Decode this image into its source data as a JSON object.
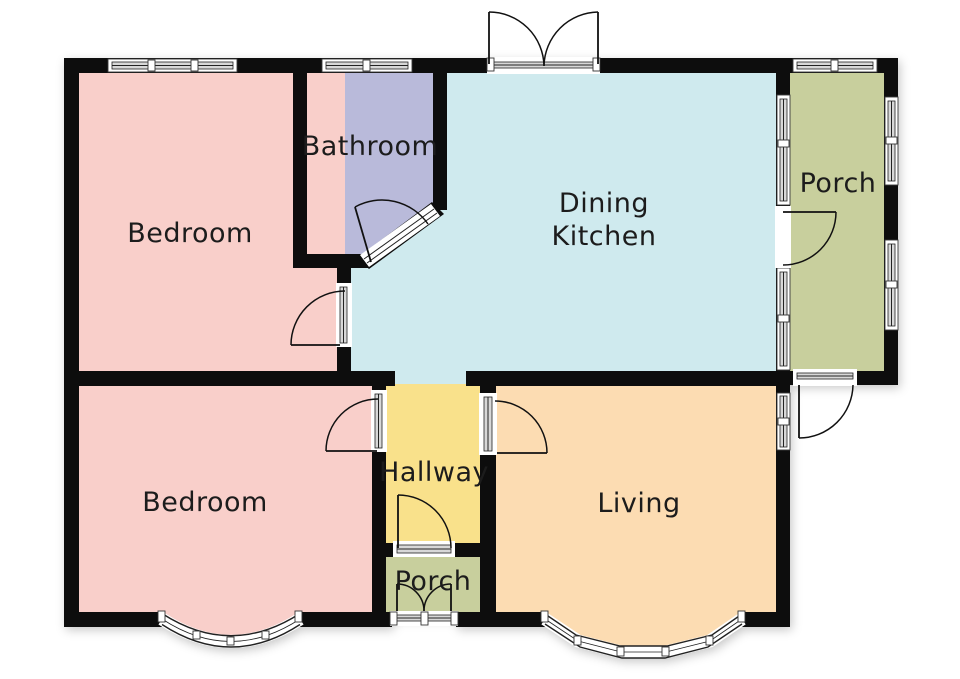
{
  "floor_plan": {
    "rooms": {
      "bedroom_top": {
        "label": "Bedroom"
      },
      "bathroom": {
        "label": "Bathroom"
      },
      "dining_kitchen": {
        "label_line1": "Dining",
        "label_line2": "Kitchen"
      },
      "porch_side": {
        "label": "Porch"
      },
      "bedroom_bottom": {
        "label": "Bedroom"
      },
      "hallway": {
        "label": "Hallway"
      },
      "living": {
        "label": "Living"
      },
      "porch_front": {
        "label": "Porch"
      }
    },
    "colors": {
      "wall": "#0d0d0d",
      "bedroom": "#f9cfca",
      "bathroom": "#b9bada",
      "dining_kitchen": "#cfeaee",
      "porch": "#c8cf9d",
      "hallway": "#f9e18b",
      "living": "#fcdcb2",
      "label_text": "#1c1c1c"
    }
  }
}
